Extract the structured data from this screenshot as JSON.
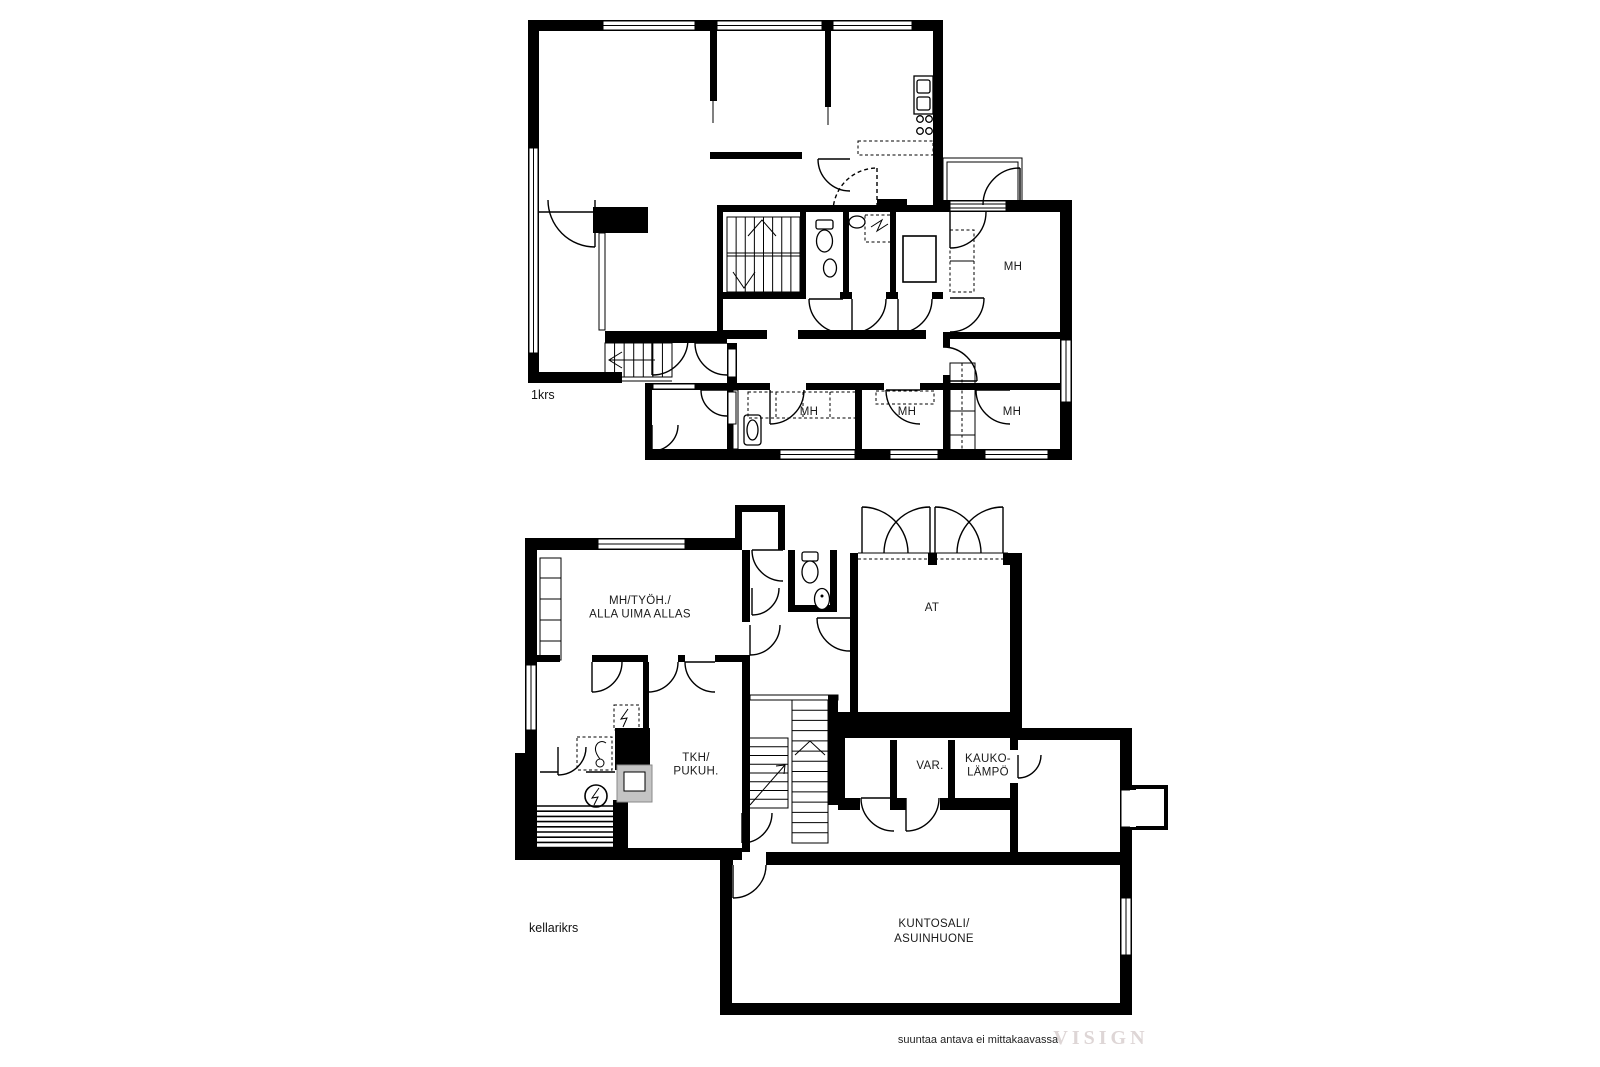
{
  "page": {
    "width": 1600,
    "height": 1067,
    "background": "#ffffff"
  },
  "plans": [
    {
      "id": "1krs",
      "floor_label": "1krs",
      "room_labels": [
        {
          "name": "bedroom-upper-right",
          "lines": [
            "MH"
          ],
          "x": 1013,
          "y": 270
        },
        {
          "name": "bedroom-bottom-1",
          "lines": [
            "MH"
          ],
          "x": 809,
          "y": 415
        },
        {
          "name": "bedroom-bottom-2",
          "lines": [
            "MH"
          ],
          "x": 907,
          "y": 415
        },
        {
          "name": "bedroom-bottom-3",
          "lines": [
            "MH"
          ],
          "x": 1012,
          "y": 415
        }
      ]
    },
    {
      "id": "kellarikrs",
      "floor_label": "kellarikrs",
      "room_labels": [
        {
          "name": "bedroom-workroom-pool-below",
          "lines": [
            "MH/TYÖH./",
            "ALLA UIMA ALLAS"
          ],
          "x": 640,
          "y": 604
        },
        {
          "name": "garage",
          "lines": [
            "AT"
          ],
          "x": 932,
          "y": 611
        },
        {
          "name": "utility-dressing",
          "lines": [
            "TKH/",
            "PUKUH."
          ],
          "x": 696,
          "y": 761
        },
        {
          "name": "storage",
          "lines": [
            "VAR."
          ],
          "x": 930,
          "y": 769
        },
        {
          "name": "district-heating",
          "lines": [
            "KAUKO-",
            "LÄMPÖ"
          ],
          "x": 988,
          "y": 762
        },
        {
          "name": "gym-living-room",
          "lines": [
            "KUNTOSALI/",
            "ASUINHUONE"
          ],
          "x": 934,
          "y": 927
        }
      ]
    }
  ],
  "footer": {
    "disclaimer": "suuntaa antava ei mittakaavassa",
    "watermark": "VISIGN"
  },
  "colors": {
    "wall": "#000000",
    "background": "#ffffff",
    "label": "#1a1a1a",
    "stove": "#c4c4c4",
    "watermark": "#ded6d6"
  }
}
